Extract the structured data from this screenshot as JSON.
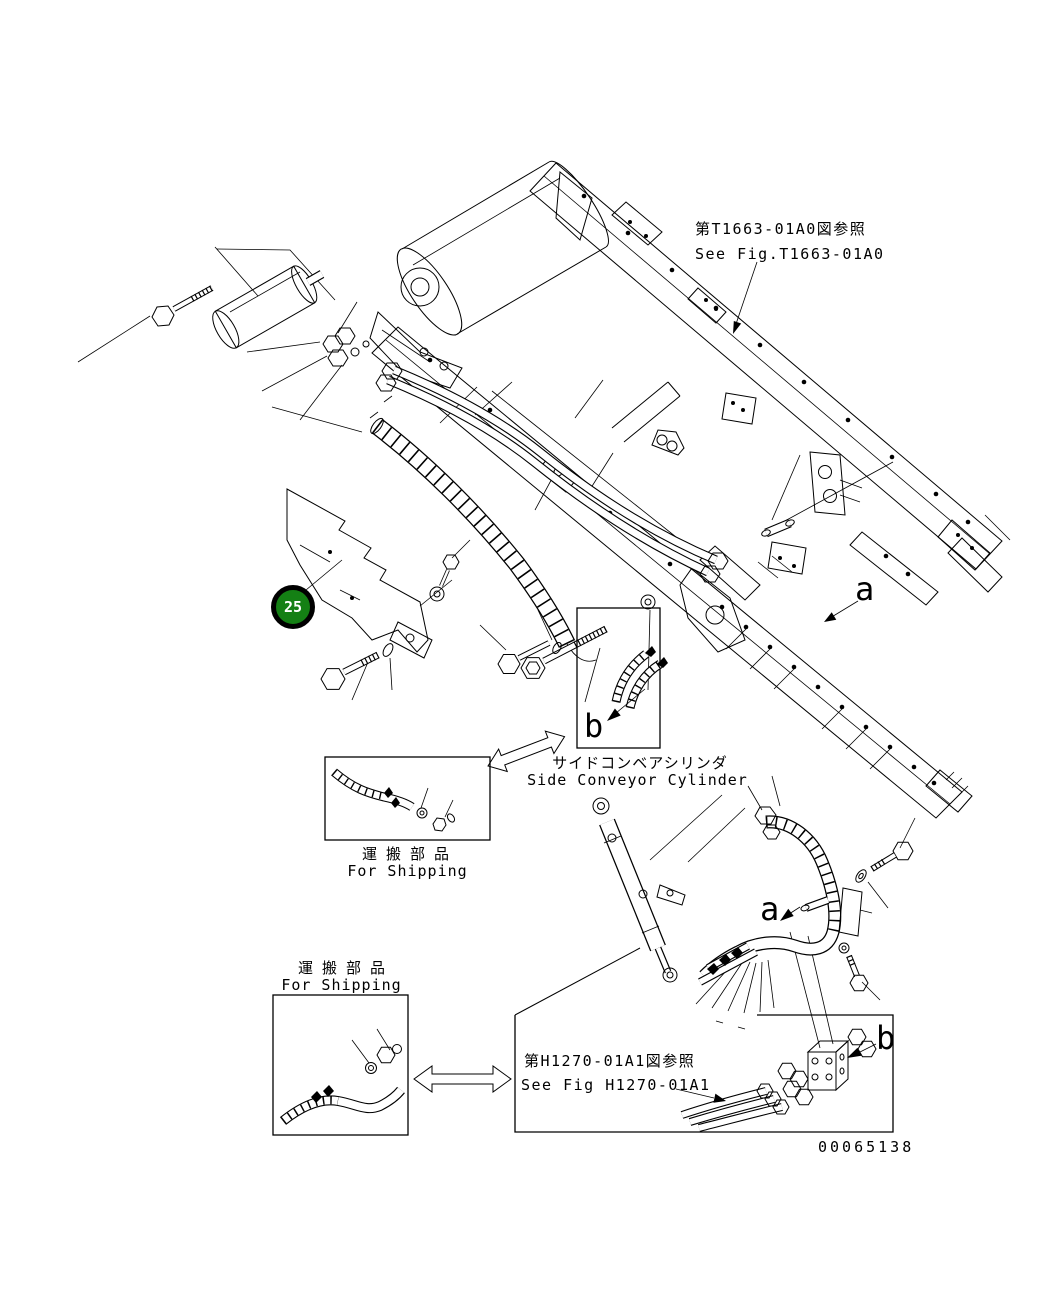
{
  "page": {
    "background": "#ffffff",
    "line_color": "#000000"
  },
  "refs": {
    "t1663": {
      "jp": "第T1663-01A0図参照",
      "en": "See Fig.T1663-01A0"
    },
    "h1270": {
      "jp": "第H1270-01A1図参照",
      "en": "See Fig H1270-01A1"
    }
  },
  "labels": {
    "side_conveyor": {
      "jp": "サイドコンベアシリンダ",
      "en": "Side Conveyor Cylinder"
    },
    "shipping": {
      "jp": "運搬部品",
      "en": "For Shipping"
    }
  },
  "balloon": {
    "number": "25",
    "fill": "#148014",
    "ring": "#000000",
    "text_color": "#ffffff"
  },
  "view_letters": {
    "a": "a",
    "b": "b"
  },
  "drawing_number": "00065138"
}
